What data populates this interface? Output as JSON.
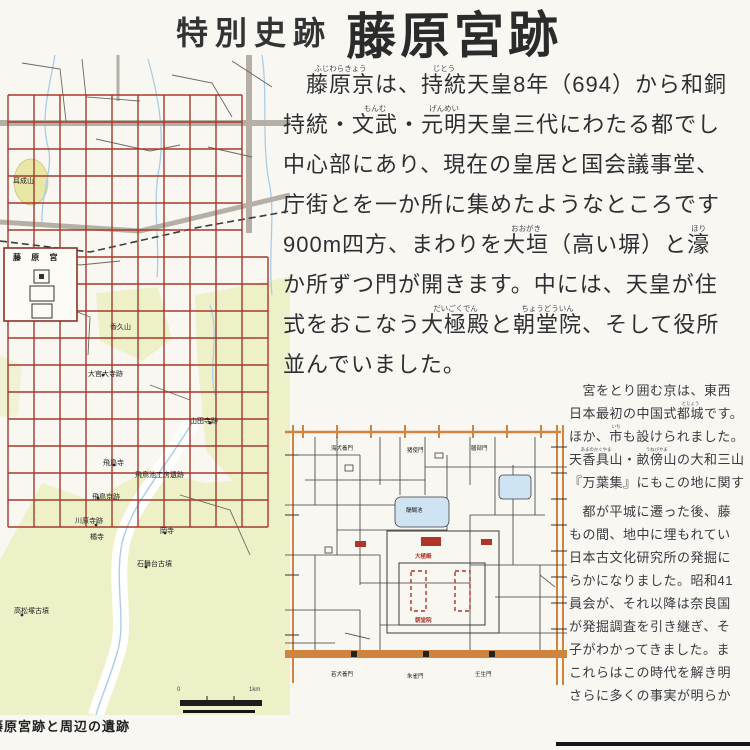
{
  "sign": {
    "title_prefix": "特別史跡",
    "title_main": "藤原宮跡",
    "caption": "藤原宮跡と周辺の遺跡"
  },
  "main_paragraph": {
    "lines": [
      [
        {
          "t": "　"
        },
        {
          "t": "藤原京",
          "r": "ふじわらきょう"
        },
        {
          "t": "は、"
        },
        {
          "t": "持統",
          "r": "じとう"
        },
        {
          "t": "天皇8年（694）から和銅"
        }
      ],
      [
        {
          "t": "持統・"
        },
        {
          "t": "文武",
          "r": "もんむ"
        },
        {
          "t": "・"
        },
        {
          "t": "元明",
          "r": "げんめい"
        },
        {
          "t": "天皇三代にわたる都でし"
        }
      ],
      [
        {
          "t": "中心部にあり、現在の皇居と国会議事堂、"
        }
      ],
      [
        {
          "t": "庁街とを一か所に集めたようなところです"
        }
      ],
      [
        {
          "t": "900m四方、まわりを"
        },
        {
          "t": "大垣",
          "r": "おおがき"
        },
        {
          "t": "（高い塀）と"
        },
        {
          "t": "濠",
          "r": "ほり"
        }
      ],
      [
        {
          "t": "か所ずつ門が開きます。中には、天皇が住"
        }
      ],
      [
        {
          "t": "式をおこなう"
        },
        {
          "t": "大極殿",
          "r": "だいごくでん"
        },
        {
          "t": "と"
        },
        {
          "t": "朝堂院",
          "r": "ちょうどういん"
        },
        {
          "t": "、そして役所"
        }
      ],
      [
        {
          "t": "並んでいました。"
        }
      ]
    ]
  },
  "side_paragraph": {
    "lines": [
      {
        "segs": [
          {
            "t": "　宮をとり囲む京は、東西"
          }
        ]
      },
      {
        "segs": [
          {
            "t": "日本最初の中国式"
          },
          {
            "t": "都城",
            "r": "とじょう"
          },
          {
            "t": "です。"
          }
        ]
      },
      {
        "segs": [
          {
            "t": "ほか、"
          },
          {
            "t": "市",
            "r": "いち"
          },
          {
            "t": "も設けられました。"
          }
        ]
      },
      {
        "segs": [
          {
            "t": "天香具山",
            "r": "あまのかぐやま"
          },
          {
            "t": "・"
          },
          {
            "t": "畝傍山",
            "r": "うねびやま"
          },
          {
            "t": "の大和三山"
          }
        ]
      },
      {
        "segs": [
          {
            "t": "『万葉集』にもこの地に関す"
          }
        ]
      },
      {
        "gap": true,
        "segs": [
          {
            "t": "　都が平城に遷った後、藤"
          }
        ]
      },
      {
        "segs": [
          {
            "t": "もの間、地中に埋もれてい"
          }
        ]
      },
      {
        "segs": [
          {
            "t": "日本古文化研究所の発掘に"
          }
        ]
      },
      {
        "segs": [
          {
            "t": "らかになりました。昭和41"
          }
        ]
      },
      {
        "segs": [
          {
            "t": "員会が、それ以降は奈良国"
          }
        ]
      },
      {
        "segs": [
          {
            "t": "が発掘調査を引き継ぎ、そ"
          }
        ]
      },
      {
        "segs": [
          {
            "t": "子がわかってきました。ま"
          }
        ]
      },
      {
        "segs": [
          {
            "t": "これらはこの時代を解き明"
          }
        ]
      },
      {
        "segs": [
          {
            "t": "さらに多くの事実が明らか"
          }
        ]
      }
    ]
  },
  "left_map": {
    "labels": [
      {
        "text": "耳成山",
        "x": 13,
        "y": 121,
        "cls": "m-label"
      },
      {
        "text": "藤 原 宮",
        "x": 13,
        "y": 197,
        "cls": "m-strong"
      },
      {
        "text": "香久山",
        "x": 110,
        "y": 267,
        "cls": "m-label"
      },
      {
        "text": "大官大寺跡",
        "x": 88,
        "y": 314,
        "cls": "m-label"
      },
      {
        "text": "山田寺跡",
        "x": 190,
        "y": 361,
        "cls": "m-label"
      },
      {
        "text": "飛鳥寺",
        "x": 103,
        "y": 403,
        "cls": "m-label"
      },
      {
        "text": "飛鳥池工房遺跡",
        "x": 135,
        "y": 415,
        "cls": "m-label"
      },
      {
        "text": "飛鳥京跡",
        "x": 92,
        "y": 437,
        "cls": "m-label"
      },
      {
        "text": "川原寺跡",
        "x": 75,
        "y": 461,
        "cls": "m-label"
      },
      {
        "text": "橘寺",
        "x": 90,
        "y": 477,
        "cls": "m-label"
      },
      {
        "text": "岡寺",
        "x": 160,
        "y": 471,
        "cls": "m-label"
      },
      {
        "text": "石舞台古墳",
        "x": 137,
        "y": 504,
        "cls": "m-label"
      },
      {
        "text": "高松塚古墳",
        "x": 14,
        "y": 551,
        "cls": "m-label"
      },
      {
        "text": "0",
        "x": 177,
        "y": 632,
        "cls": "m-tiny"
      },
      {
        "text": "1km",
        "x": 249,
        "y": 632,
        "cls": "m-tiny"
      }
    ]
  },
  "small_map": {
    "labels": [
      {
        "text": "海犬養門",
        "x": 46,
        "y": 19,
        "cls": "s-label"
      },
      {
        "text": "猪使門",
        "x": 122,
        "y": 21,
        "cls": "s-label"
      },
      {
        "text": "膳部門",
        "x": 186,
        "y": 19,
        "cls": "s-label"
      },
      {
        "text": "醍醐池",
        "x": 121,
        "y": 81,
        "cls": "s-label"
      },
      {
        "text": "大極殿",
        "x": 130,
        "y": 127,
        "cls": "s-label s-red"
      },
      {
        "text": "朝堂院",
        "x": 130,
        "y": 191,
        "cls": "s-label s-red"
      },
      {
        "text": "若犬養門",
        "x": 46,
        "y": 245,
        "cls": "s-label"
      },
      {
        "text": "朱雀門",
        "x": 122,
        "y": 247,
        "cls": "s-label"
      },
      {
        "text": "壬生門",
        "x": 190,
        "y": 245,
        "cls": "s-label"
      }
    ]
  },
  "colors": {
    "paper": "#f8f7f2",
    "ink": "#2f2f33",
    "grid_red": "#a63a2a",
    "terrain": "#eef0c8",
    "hill_yellow": "#e9e7a6",
    "water": "#a8cde8",
    "road_gray": "#b6afa6",
    "orange": "#cf8440",
    "mark_red": "#b03428"
  }
}
